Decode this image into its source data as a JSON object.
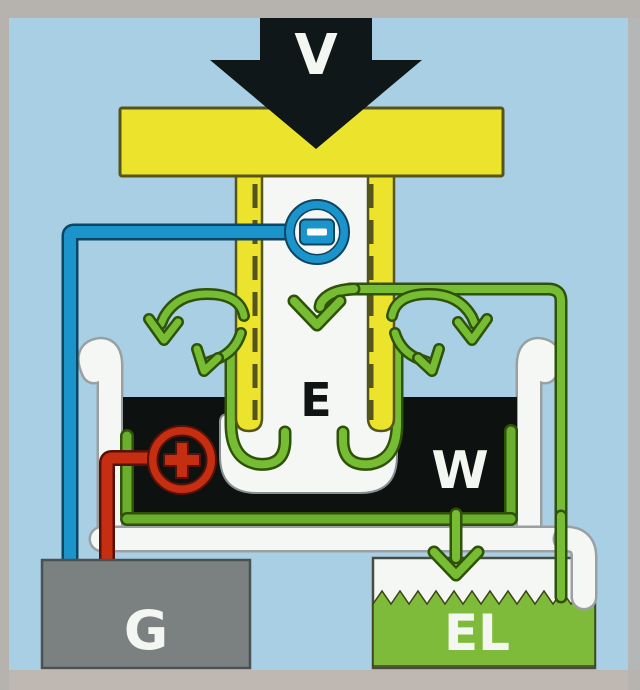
{
  "diagram": {
    "labels": {
      "vapor_arrow": "V",
      "electrode": "E",
      "tank_liquid": "W",
      "generator": "G",
      "electrolyte": "EL"
    },
    "icons": {
      "big-down-arrow-icon": "black filled arrow pointing down onto electrode",
      "minus-terminal-icon": "blue ring with minus pad",
      "plus-terminal-icon": "red ring with plus cross",
      "flow-down-arrow-icon": "green chevron arrow pointing down inside tube",
      "drain-arrow-icon": "green chevron arrow pointing down into EL reservoir",
      "vortex-icon": "green circulation swirl arrows (left and right)",
      "liquid-surface-zigzag": "jagged liquid level line in EL reservoir"
    },
    "colors": {
      "sky": "#a9cfe4",
      "border-gray": "#b6b3ae",
      "border-gray2": "#beb7b2",
      "yellow": "#ece32c",
      "yellow-dark": "#55541a",
      "arrow-black": "#0f1719",
      "liquid-black": "#0d1110",
      "green": "#76bd33",
      "green2": "#69af2d",
      "green-dark": "#2f5208",
      "el-green": "#7fbb3a",
      "blue": "#1b94cc",
      "blue-dark": "#0d4663",
      "red": "#c62e12",
      "red-dark": "#571108",
      "gray-box": "#7b8081",
      "gray-box-edge": "#4b5052",
      "tube-white": "#f5f7f4",
      "outline-gray": "#9aa0a2",
      "label-white": "#f4f6f2",
      "label-black": "#101412"
    }
  }
}
